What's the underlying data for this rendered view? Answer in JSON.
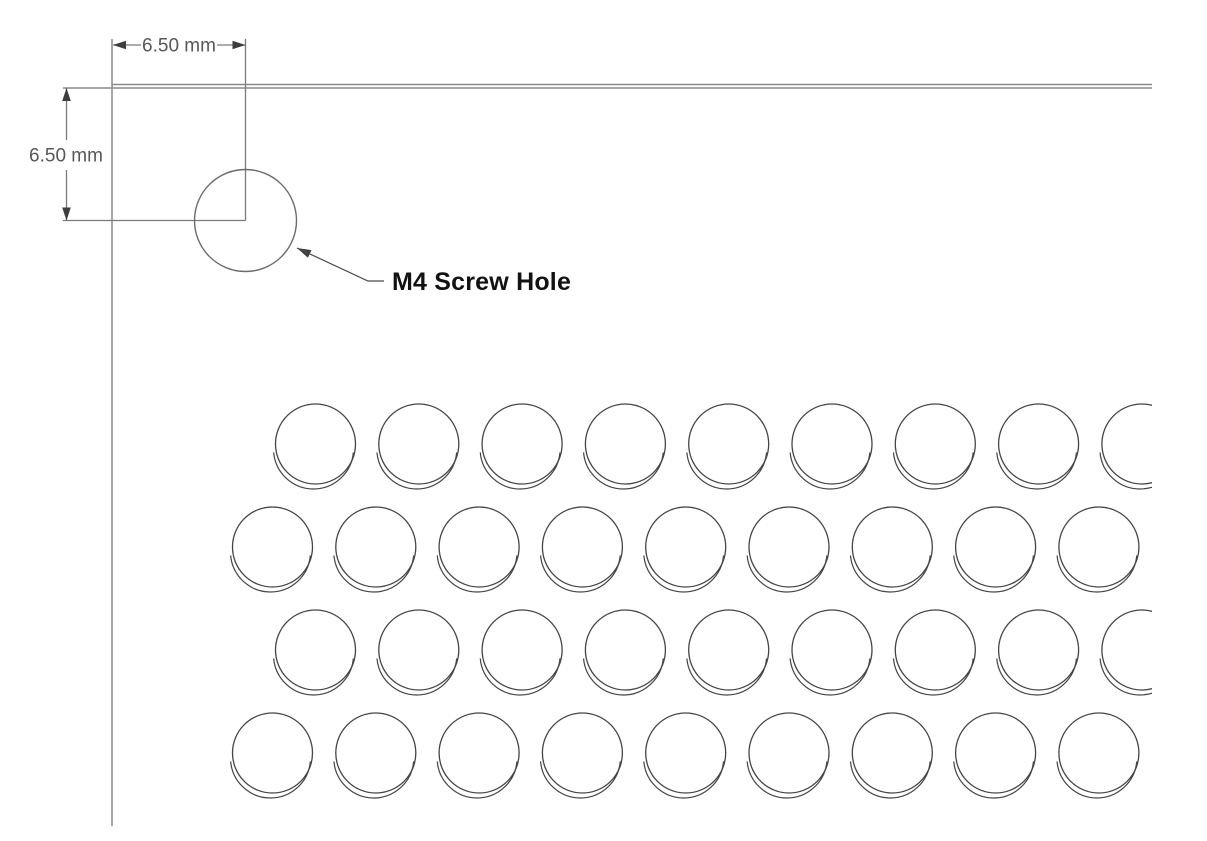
{
  "page": {
    "background": "#ffffff",
    "width": 1207,
    "height": 841
  },
  "labels": {
    "horizontal_dim": "6.50 mm",
    "vertical_dim": "6.50 mm",
    "screw_hole_label": "M4 Screw Hole"
  },
  "colors": {
    "background": "#ffffff",
    "panel_edge": "#8a8a8a",
    "dim_line": "#7a7a7a",
    "arrow": "#3d3d3d",
    "dim_text": "#575757",
    "hole_stroke": "#6b6b6b",
    "grid_stroke": "#454545",
    "leader_line": "#4a4a4a",
    "label_text": "#121212"
  },
  "drawing": {
    "panel_edges": {
      "top_outer": [
        112,
        84.5,
        1152,
        84.5
      ],
      "top_inner": [
        63,
        88,
        1152,
        88
      ],
      "left": [
        112,
        39,
        112,
        826
      ]
    },
    "extension_lines": [
      [
        245.5,
        39,
        245.5,
        220.5
      ],
      [
        63,
        220.5,
        245.5,
        220.5
      ]
    ],
    "dim_h": {
      "segments": [
        [
          113,
          45,
          141,
          45
        ],
        [
          217,
          45,
          245.5,
          45
        ]
      ],
      "text": {
        "x": 179,
        "y": 46
      }
    },
    "dim_v": {
      "segments": [
        [
          66.5,
          88,
          66.5,
          140
        ],
        [
          66.5,
          170,
          66.5,
          220.5
        ]
      ],
      "text": {
        "x": 66,
        "y": 156
      }
    },
    "arrows": [
      {
        "x": 113,
        "y": 45,
        "angle": 180,
        "len": 13,
        "hw": 4.3
      },
      {
        "x": 245.5,
        "y": 45,
        "angle": 0,
        "len": 13,
        "hw": 4.3
      },
      {
        "x": 66.5,
        "y": 88,
        "angle": -90,
        "len": 13,
        "hw": 4.3
      },
      {
        "x": 66.5,
        "y": 220.5,
        "angle": 90,
        "len": 13,
        "hw": 4.3
      },
      {
        "x": 297,
        "y": 248,
        "angle": -155,
        "len": 14,
        "hw": 4.2
      }
    ],
    "screw_hole": {
      "cx": 245.5,
      "cy": 220.5,
      "r": 51
    },
    "leader": {
      "points": "297,248 368,281 384,281",
      "label": {
        "x": 392,
        "y": 282
      }
    },
    "grid": {
      "radius": 40,
      "lip": {
        "dx": -2,
        "dy": 5,
        "start_deg": 175,
        "end_deg": 5
      },
      "spacing": 103.3,
      "count_per_row": 9,
      "rows": [
        {
          "y": 444,
          "x0": 315.5
        },
        {
          "y": 547,
          "x0": 272.5
        },
        {
          "y": 650,
          "x0": 315.5
        },
        {
          "y": 753,
          "x0": 272.5
        }
      ],
      "clip_width": 1152
    }
  }
}
